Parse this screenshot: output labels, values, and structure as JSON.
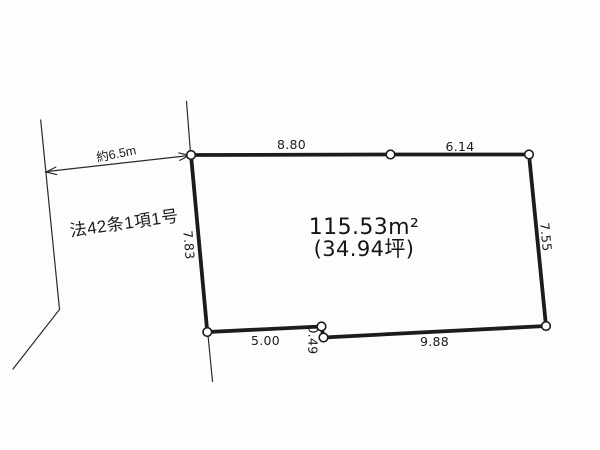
{
  "plot": {
    "area_m2": "115.53m²",
    "area_tsubo": "(34.94坪)",
    "dimensions": {
      "top_left_segment": "8.80",
      "top_right_segment": "6.14",
      "right_side": "7.55",
      "left_side": "7.83",
      "bottom_left_segment": "5.00",
      "bottom_jog": "0.49",
      "bottom_right_segment": "9.88"
    }
  },
  "road": {
    "width_label": "約6.5m",
    "classification_label": "法42条1項1号"
  },
  "colors": {
    "ink": "#1c1c1c",
    "paper": "#fdfdfb"
  }
}
